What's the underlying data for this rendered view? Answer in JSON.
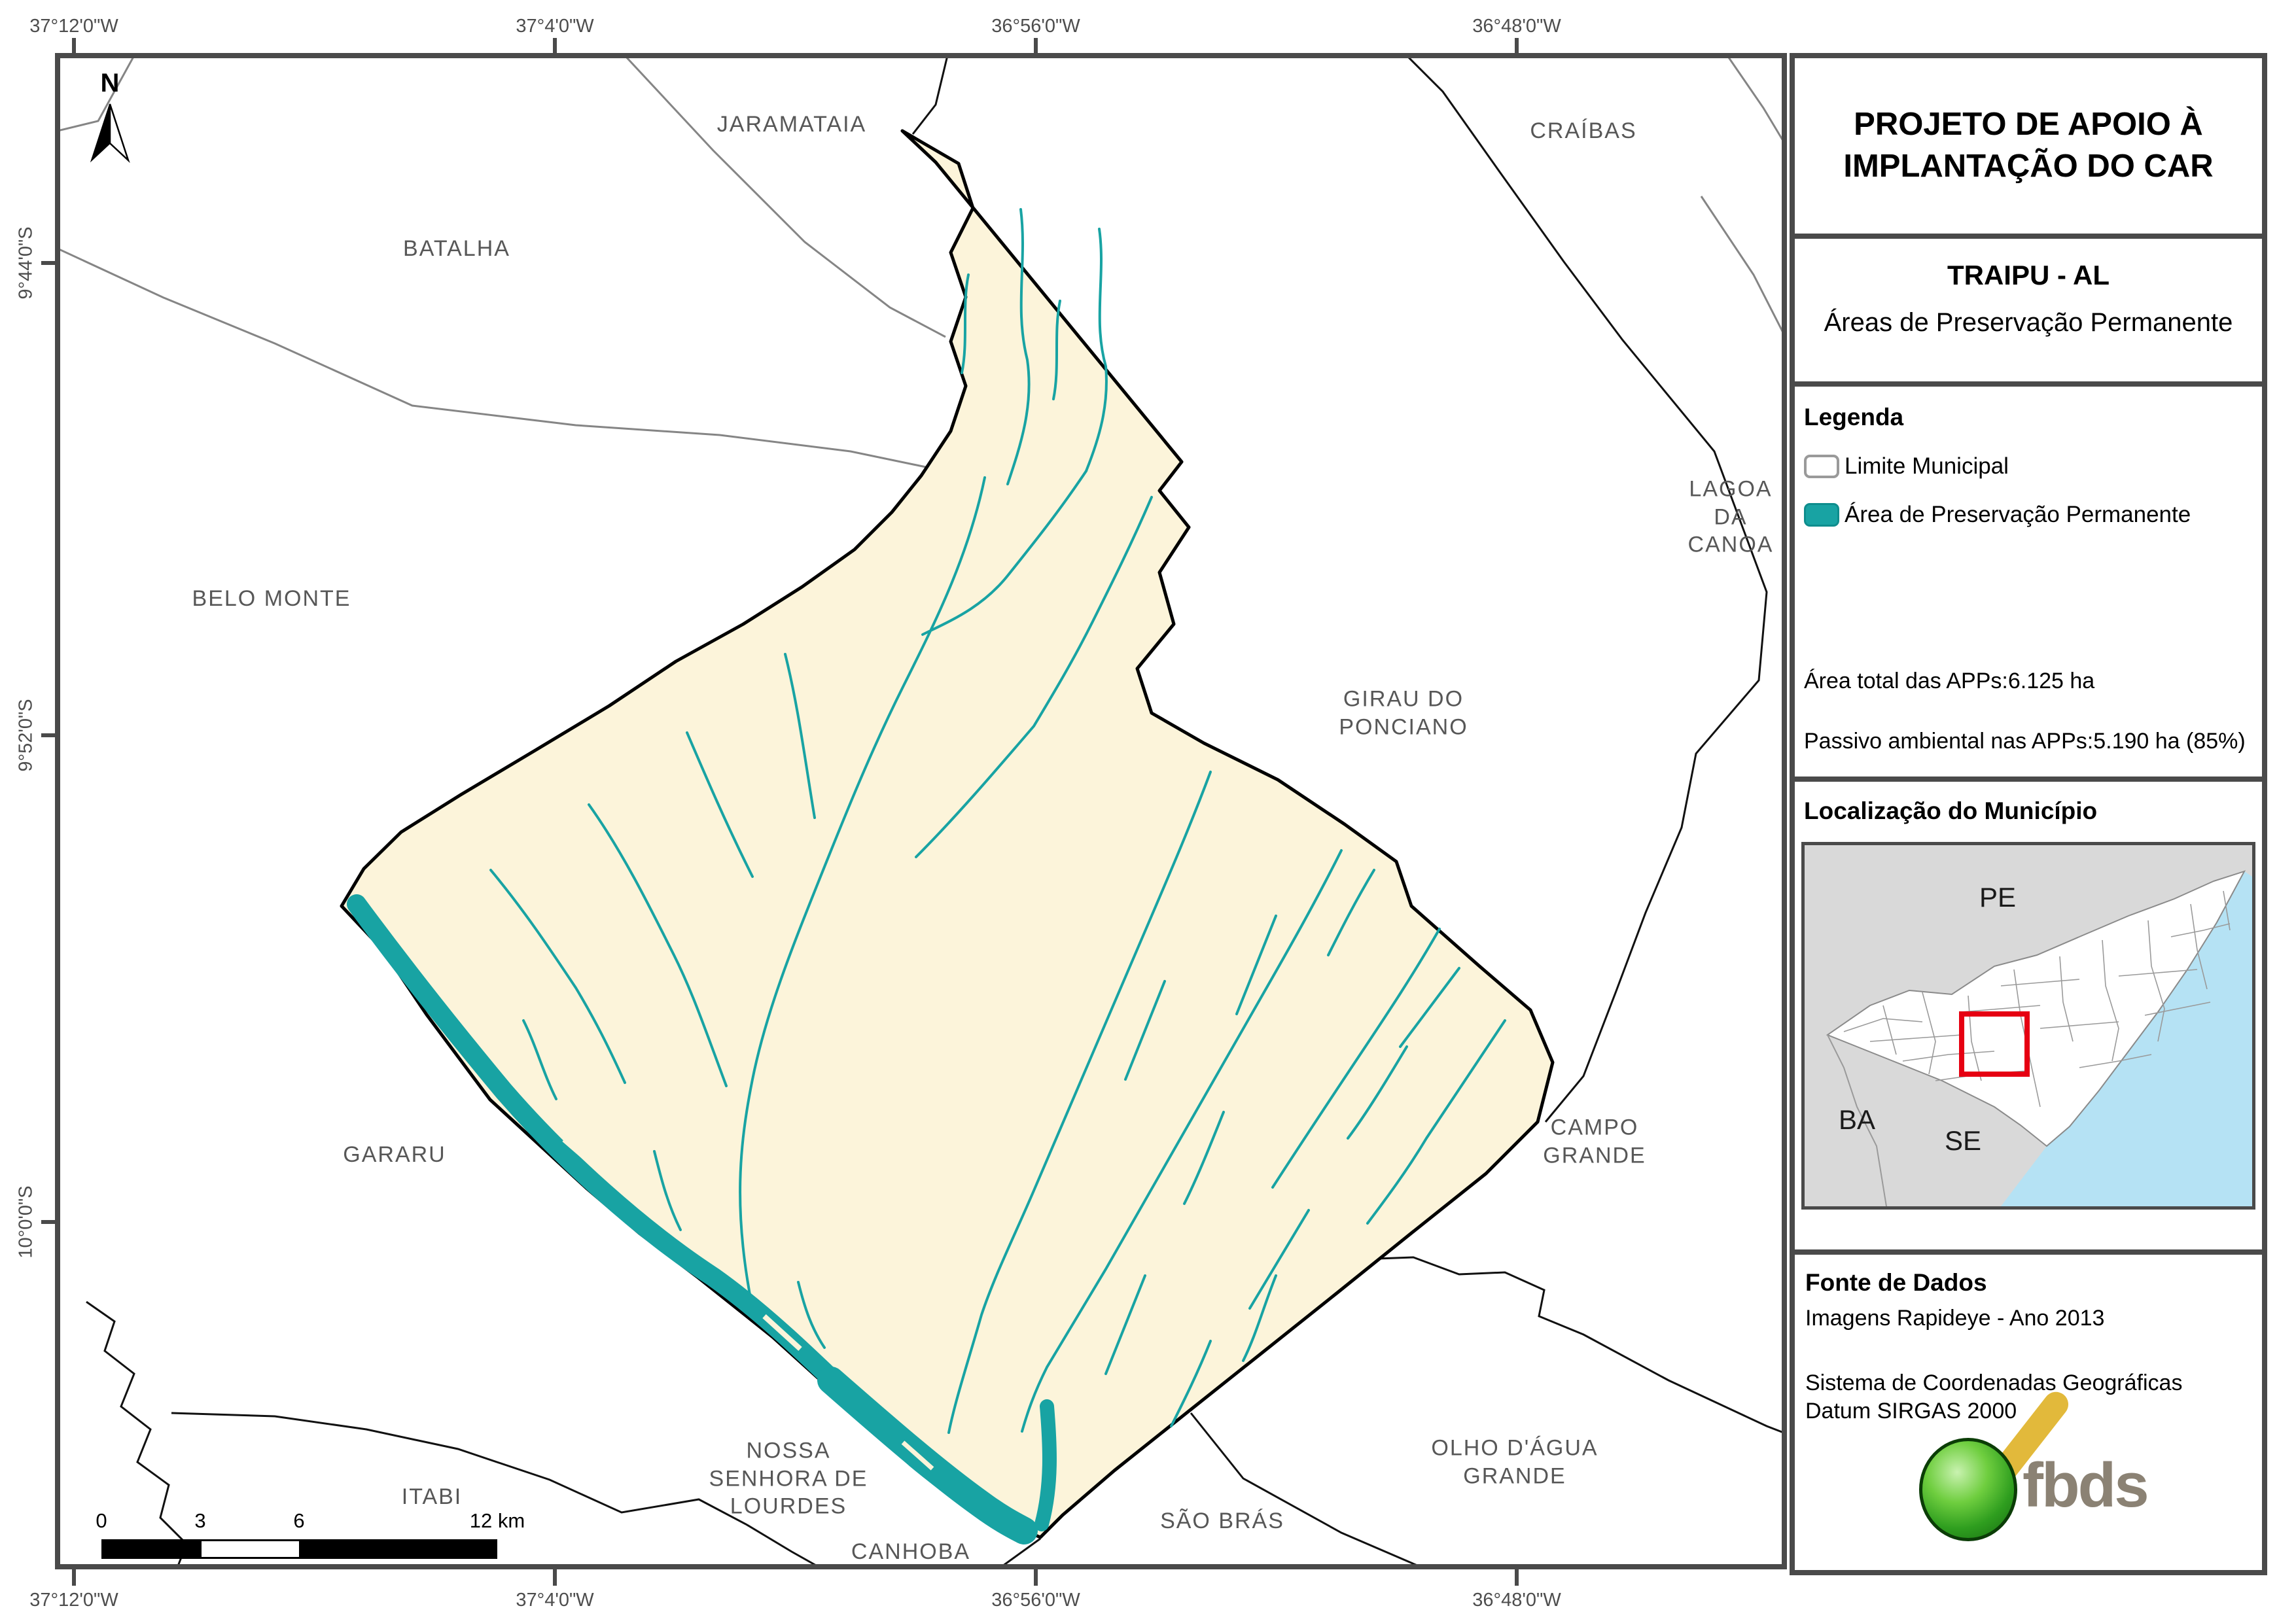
{
  "map": {
    "north_label": "N",
    "axis_top": [
      "37°12'0\"W",
      "37°4'0\"W",
      "36°56'0\"W",
      "36°48'0\"W"
    ],
    "axis_bottom": [
      "37°12'0\"W",
      "37°4'0\"W",
      "36°56'0\"W",
      "36°48'0\"W"
    ],
    "axis_left": [
      "9°44'0\"S",
      "9°52'0\"S",
      "10°0'0\"S"
    ],
    "labels": {
      "jaramataia": "JARAMATAIA",
      "batalha": "BATALHA",
      "craibas": "CRAÍBAS",
      "belo_monte": "BELO MONTE",
      "lagoa_da_canoa": "LAGOA\nDA CANOA",
      "girau": "GIRAU DO\nPONCIANO",
      "campo_grande": "CAMPO GRANDE",
      "gararu": "GARARU",
      "itabi": "ITABI",
      "nossa_senhora": "NOSSA\nSENHORA DE\nLOURDES",
      "canhoba": "CANHOBA",
      "sao_bras": "SÃO BRÁS",
      "olho_dagua": "OLHO D'ÁGUA\nGRANDE"
    },
    "scalebar": {
      "t0": "0",
      "t3": "3",
      "t6": "6",
      "t12": "12 km"
    }
  },
  "panel": {
    "title": {
      "line1": "PROJETO DE APOIO À",
      "line2": "IMPLANTAÇÃO DO CAR"
    },
    "municipality": "TRAIPU - AL",
    "subtitle": "Áreas de Preservação Permanente",
    "legend": {
      "heading": "Legenda",
      "items": [
        {
          "label": "Limite Municipal",
          "swatch": "white-outline"
        },
        {
          "label": "Área de Preservação Permanente",
          "swatch": "teal-fill"
        }
      ]
    },
    "stats": [
      "Área total das APPs:6.125 ha",
      "Passivo ambiental nas APPs:5.190 ha (85%)"
    ],
    "location": {
      "heading": "Localização do Município",
      "pe": "PE",
      "ba": "BA",
      "se": "SE"
    },
    "source": {
      "heading": "Fonte de Dados",
      "lines": [
        "Imagens Rapideye - Ano 2013",
        "Sistema de Coordenadas Geográficas",
        "Datum SIRGAS 2000"
      ]
    },
    "logo": {
      "text": "fbds"
    }
  },
  "colors": {
    "frame": "#4a4a4a",
    "app_teal": "#18a3a3",
    "municipality_fill": "#fcf4da",
    "neighbor_boundary_gray": "#858585",
    "neighbor_boundary_black": "#111111",
    "map_label_gray": "#575757",
    "inset_background": "#d9d9d9",
    "inset_ocean": "#b5e2f4",
    "inset_highlight_red": "#e60012",
    "logo_text_color": "#8b8274"
  }
}
